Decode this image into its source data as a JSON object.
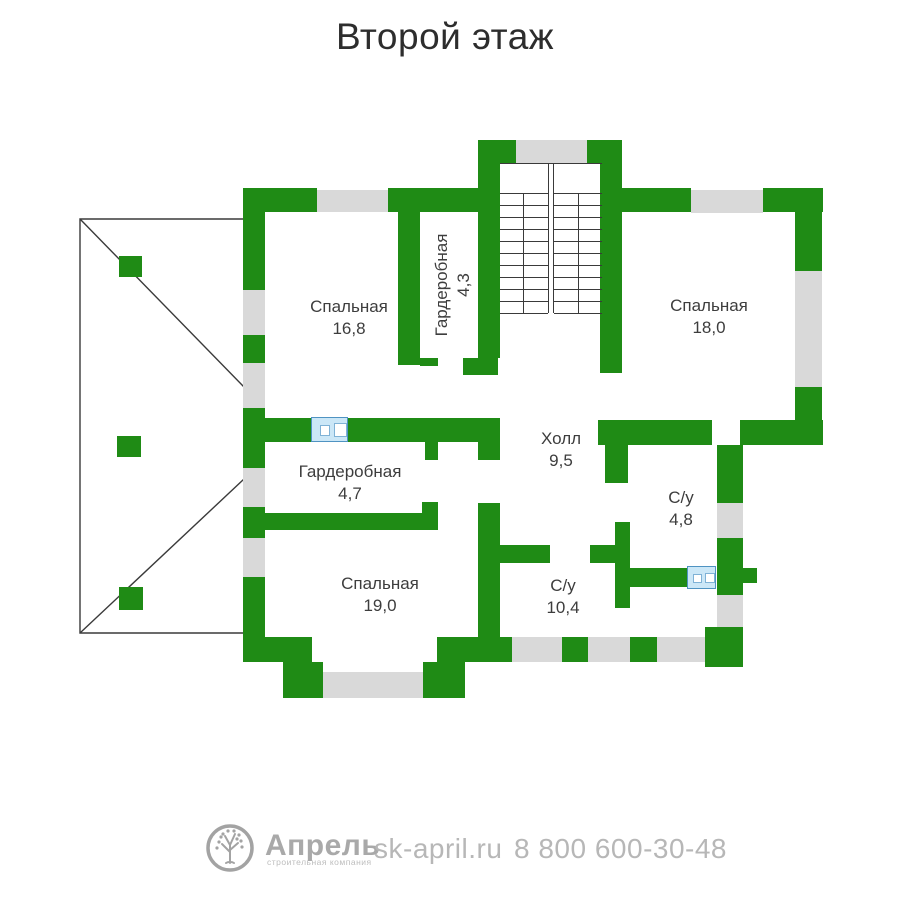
{
  "title": "Второй этаж",
  "colors": {
    "wall": "#1f8b15",
    "window": "#d9d9d9",
    "line": "#3a3a3a",
    "label": "#3d3d3d",
    "title-color": "#2d2d2d",
    "rad-fill": "#cbe7f7",
    "rad-border": "#4f93c2",
    "footer-gray": "#b7b7b7",
    "brand-gray": "#a9a9a9"
  },
  "rooms": [
    {
      "name": "Спальная",
      "area": "16,8"
    },
    {
      "name": "Гардеробная",
      "area": "4,3"
    },
    {
      "name": "Спальная",
      "area": "18,0"
    },
    {
      "name": "Холл",
      "area": "9,5"
    },
    {
      "name": "Гардеробная",
      "area": "4,7"
    },
    {
      "name": "С/у",
      "area": "4,8"
    },
    {
      "name": "Спальная",
      "area": "19,0"
    },
    {
      "name": "С/у",
      "area": "10,4"
    }
  ],
  "footer": {
    "brand": "Апрель",
    "brand_subtitle": "строительная компания",
    "website": "sk-april.ru",
    "phone": "8 800 600-30-48"
  }
}
